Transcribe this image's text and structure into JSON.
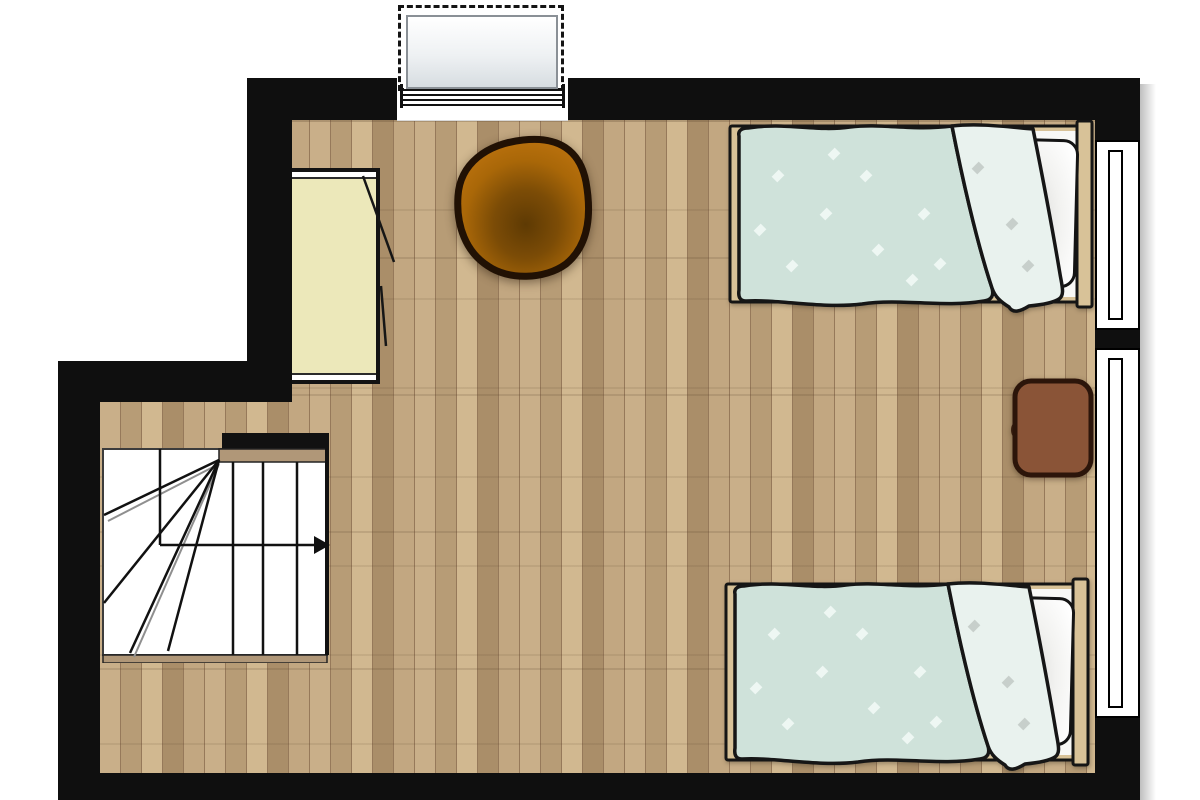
{
  "plan": {
    "kind": "bedroom-floor-plan",
    "colors": {
      "wall": "#0f0f0f",
      "outside": "#ffffff",
      "floor_base": "#c3a982",
      "floor_plank_light": "#d1b890",
      "floor_plank_dark": "#aa8e69",
      "bed_frame": "#d8c298",
      "duvet": "#cfe2da",
      "duvet_fold": "#e9f2ee",
      "duvet_diamond": "#eef7f3",
      "fold_diamond": "#c7cfcb",
      "pillow": "#ffffff",
      "wardrobe_fill": "#ece8ba",
      "chair_rim": "#b8700d",
      "chair_seat": "#5e3a04",
      "chair_outline": "#211104",
      "table_fill": "#8a5437",
      "table_outline": "#2c150a",
      "stair_tread": "#ffffff",
      "stair_wood": "#b09778",
      "outline": "#161616"
    },
    "elements": [
      {
        "name": "entry-door",
        "symbol": "open-door-with-dashed-swing"
      },
      {
        "name": "wardrobe",
        "symbol": "cabinet-with-ajar-doors"
      },
      {
        "name": "armchair",
        "symbol": "round-seat-top-view"
      },
      {
        "name": "bed-upper",
        "symbol": "single-bed-duvet-pillow"
      },
      {
        "name": "bed-lower",
        "symbol": "single-bed-duvet-pillow"
      },
      {
        "name": "side-table",
        "symbol": "rounded-square-table"
      },
      {
        "name": "window-upper",
        "symbol": "double-line-window"
      },
      {
        "name": "window-lower",
        "symbol": "double-line-window"
      },
      {
        "name": "staircase",
        "symbol": "winder-stairs-with-direction-arrow"
      }
    ]
  }
}
